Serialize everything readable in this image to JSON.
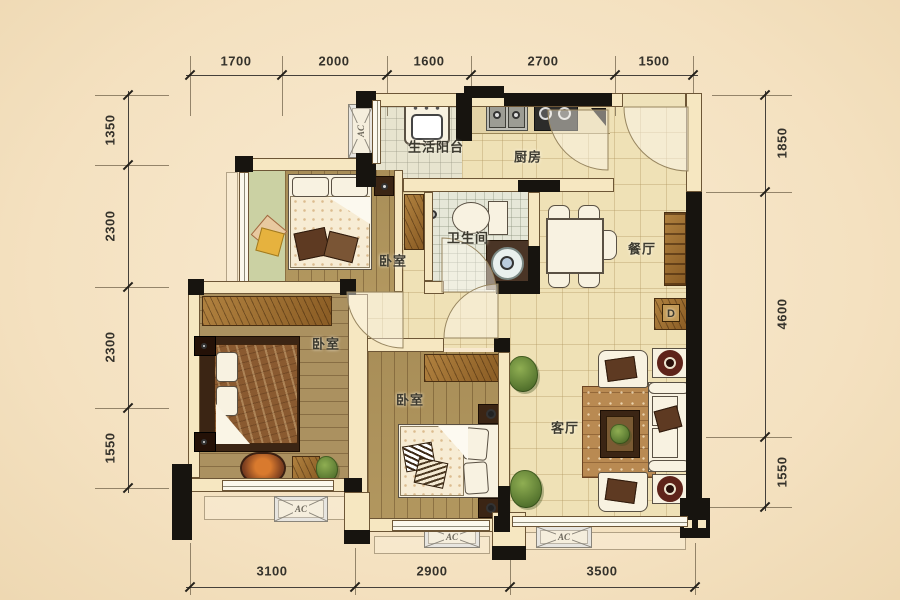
{
  "dimensions": {
    "top": [
      "1700",
      "2000",
      "1600",
      "2700",
      "1500"
    ],
    "left": [
      "1350",
      "2300",
      "2300",
      "1550"
    ],
    "right": [
      "1850",
      "4600",
      "1550"
    ],
    "bottom": [
      "3100",
      "2900",
      "3500"
    ]
  },
  "rooms": {
    "balcony": "生活阳台",
    "kitchen": "厨房",
    "bathroom": "卫生间",
    "dining": "餐厅",
    "bedroom_top": "卧室",
    "bedroom_master": "卧室",
    "bedroom_bottom": "卧室",
    "living": "客厅"
  },
  "labels": {
    "ac": "AC",
    "distribution_box": "D"
  },
  "colors": {
    "background": "#f4e1c0",
    "wall": "#f6e7c1",
    "column": "#17140f",
    "tile_floor": "#efe1b6",
    "wood_floor": "#b2975f",
    "bath_tile": "#e6e7d8",
    "bay_green": "#cbd1a3",
    "furniture_wood": "#8a5c24"
  }
}
